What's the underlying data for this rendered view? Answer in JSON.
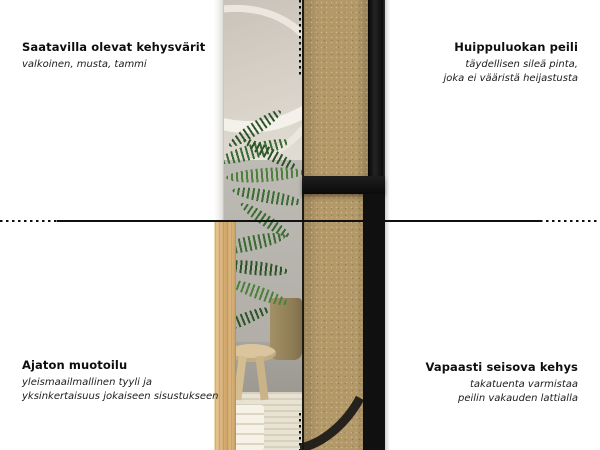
{
  "annotations": {
    "top_left": {
      "title": "Saatavilla olevat kehysvärit",
      "subtitle_lines": [
        "valkoinen, musta, tammi"
      ]
    },
    "top_right": {
      "title": "Huippuluokan peili",
      "subtitle_lines": [
        "täydellisen sileä pinta,",
        "joka ei vääristä heijastusta"
      ]
    },
    "bottom_left": {
      "title": "Ajaton muotoilu",
      "subtitle_lines": [
        "yleismaailmallinen tyyli ja",
        "yksinkertaisuus jokaiseen sisustukseen"
      ]
    },
    "bottom_right": {
      "title": "Vapaasti seisova kehys",
      "subtitle_lines": [
        "takatuenta varmistaa",
        "peilin vakauden lattialla"
      ]
    }
  },
  "colors": {
    "text": "#111111",
    "divider_line": "#101010",
    "mdf_back": "#b49968",
    "oak_frame": "#d9b47e",
    "black_frame": "#141414",
    "white_frame": "#f4f3f1",
    "plant_green": "#3a6c33"
  }
}
